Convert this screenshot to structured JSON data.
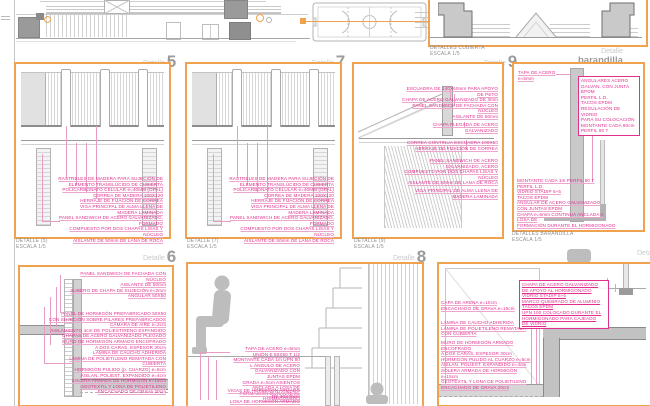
{
  "top": {
    "roof_caption": [
      "DETALLES CUBIERTA",
      "ESCALA 1/5"
    ]
  },
  "labels": {
    "detalle": "Detalle",
    "p5": "5",
    "p7": "7",
    "p9": "9",
    "p6": "6",
    "p8": "8",
    "barandilla": "barandilla"
  },
  "captions": {
    "p5": [
      "DETALLE (5)",
      "ESCALA 1/5"
    ],
    "p7": [
      "DETALLE (7)",
      "ESCALA 1/5"
    ],
    "p9": [
      "DETALLE (9)",
      "ESCALA 1/5"
    ],
    "barandilla": [
      "DETALLES BARANDILLA",
      "ESCALA 1/5"
    ]
  },
  "panels": {
    "p5": {
      "notes": [
        "RASTRELES DE MADERA PARA SUJECIÓN DE",
        "ELEMENTO TRANSLÚCIDO DE CUBIERTA",
        "POLICARBONATO CELULAR e=40MM (OPAL)",
        "CORREA DE MADERA 100X120",
        "HERRAJE DE FIJACIÓN DE CORREA",
        "VIGA PRINCIPAL DE ALMA LLENA DE",
        "MADERA LAMINADA",
        "PANEL SANDWICH DE ACERO GALVANIZADO, FORMADO",
        "COMPUESTO POR DOS CHAPAS LISAS Y NÚCLEO",
        "AISLANTE DE 50mm DE LANA DE ROCA"
      ]
    },
    "p7": {
      "notes": [
        "RASTRELES DE MADERA PARA SUJECIÓN DE",
        "ELEMENTO TRANSLÚCIDO DE CUBIERTA",
        "POLICARBONATO CELULAR e=40MM (OPAL)",
        "CORREA DE MADERA 100X120",
        "HERRAJE DE FIJACIÓN DE CORREA",
        "VIGA PRINCIPAL DE ALMA LLENA DE",
        "MADERA LAMINADA",
        "PANEL SANDWICH DE ACERO GALVANIZADO, FORMADO",
        "COMPUESTO POR DOS CHAPAS LISAS Y NÚCLEO",
        "AISLANTE DE 50mm DE LANA DE ROCA"
      ]
    },
    "p9": {
      "notes_top": [
        "ESCUADRA DE 140X60mm PARA APOYO DE PETO",
        "CHAPA DE ACERO GALVANIZADO DE 3mm",
        "PANEL SANDWICH DE FACHADA CON NÚCLEO",
        "AISLANTE DE 50mm"
      ],
      "note_chapa": [
        "CHAPA PLEGADA DE ACERO GALVANIZADO"
      ],
      "notes_correa": [
        "CORREA CONTINUA ESCUADRA 100X50",
        "HERRAJE DE FIJACIÓN DE CORREA"
      ],
      "notes_panel": [
        "PANEL SANDWICH DE ACERO GALVANIZADO, ACERO",
        "COMPUESTO POR DOS CHAPAS LISAS Y NÚCLEO",
        "AISLANTE DE 50mm DE LANA DE ROCA"
      ],
      "notes_viga": [
        "VIGA PRINCIPAL DE ALMA LLENA DE",
        "MADERA LAMINADA"
      ]
    },
    "barandilla": {
      "tapa": "TAPA DE ACERO e=5mm",
      "frame_notes": [
        "ANGULARES ACERO",
        "GALVAN. CON JUNTA EPDM",
        "PERFIL L.D.",
        "TACOS EPDM",
        "REGULACIÓN DE VIDRIO",
        "PARA SU COLOCACIÓN",
        "MONTANTE CADA 80cm",
        "PERFIL 80 T"
      ],
      "base_notes": [
        "MONTANTE CADA 1m PERFIL 80 T",
        "PERFIL L.D.",
        "VIDRIO STADIP 5+5",
        "TACOS EPDM",
        "ANGULAR DE ACERO GALVANIZADO",
        "CON JUNTAS EPDM",
        "CHAPA e=5mm CONTINUA ANCLADA A LOSA DE",
        "FORMACIÓN DURANTE EL HORMIGONADO"
      ]
    },
    "p6": {
      "notes_top": [
        "PANEL SANDWICH DE FACHADA CON NÚCLEO",
        "AISLANTE DE 50mm",
        "SUBERO DE CHAPA DE SUJECIÓN e=2mm",
        "ANGULAR 50X50"
      ],
      "notes_mid": [
        "PANEL DE HORMIGÓN PREFABRICADO 50X50",
        "CON SUJECIÓN SOBRE PILARES PREFABRICADOS",
        "CÁMARA DE AIRE e=2cm",
        "AISLAMIENTO 4cm DE POLIESTIRENO EXPANDIDO",
        "CHAPAS DE ACERO GALVANIZADO PLEGADO",
        "MURO DE HORMIGÓN ARMADO ENCOFRADO",
        "A DOS CARAS, ESPESOR 30cm",
        "LÁMINA DE CAUCHO ADHERIDA",
        "LÁMINA DE POLIETILENO REMATADA CON CUBIERTA",
        "HORMIGÓN PULIDO (p. CUARZO) e=5cm",
        "AISLAN. POLIEST. EXPANDIDO e=4cm",
        "SOLERA ARMADA DE HORMIGÓN e=15cm",
        "GEOTEXTIL Y LONA DE POLIETILENO",
        "ENCACHADO DE GRAVA 20cm"
      ]
    },
    "p8": {
      "notes_a": [
        "TAPA DE ACERO e=5mm",
        "UNIÓN E 50X50 T 1/2",
        "MONTANTE CADA 1m UPN 80",
        "L ÁNGULO DE ACERO GALVANIZADO CON",
        "JUNTAS EPDM",
        "GRADA e=5cm ASIENTOS ANCLADA A LOSA DE",
        "FORMACIÓN DURANTE EL HORMIGONADO"
      ],
      "notes_b": [
        "VIGAS DE HORMIGÓN ARMADO DE 30X30cm",
        "LOSA DE HORMIGÓN ARMADO DE e=15cm",
        "PULIDO EN OBRA Y ACABADO ENCERADO"
      ]
    },
    "foso": {
      "notes_arena": [
        "CAPA DE ARENA e=10cm",
        "ENCACHADO DE GRAVA e=15cm"
      ],
      "notes_lamina": [
        "LÁMINA DE CAUCHO ADHERIDA",
        "LÁMINA DE POLIETILENO REMATADA CON CUBIERTA"
      ],
      "notes_muro": [
        "MURO DE HORMIGÓN ARMADO ENCOFRADO",
        "A DOS CARAS, ESPESOR 30cm",
        "HORMIGÓN PULIDO AL CUARZO e=5cm",
        "AISLAN. POLIEST. EXPANDIDO e=4cm",
        "SOLERA ARMADA DE HORMIGÓN e=15cm",
        "GEOTEXTIL Y LONA DE POLIETILENO",
        "ENCACHADO DE GRAVA 20cm"
      ],
      "frame_notes": [
        "CHAPA DE ACERO GALVANIZADO",
        "DE APOYO AL HORMIGONADO",
        "VIDRIO STADIP 5+5",
        "MARCO QUEBRADO DE ALUMINIO",
        "TACOS EPDM",
        "UPN 100 COLOCADO DURANTE EL",
        "HORMIGONADO PARA CAJEADO",
        "DE VIDRIO"
      ]
    }
  }
}
